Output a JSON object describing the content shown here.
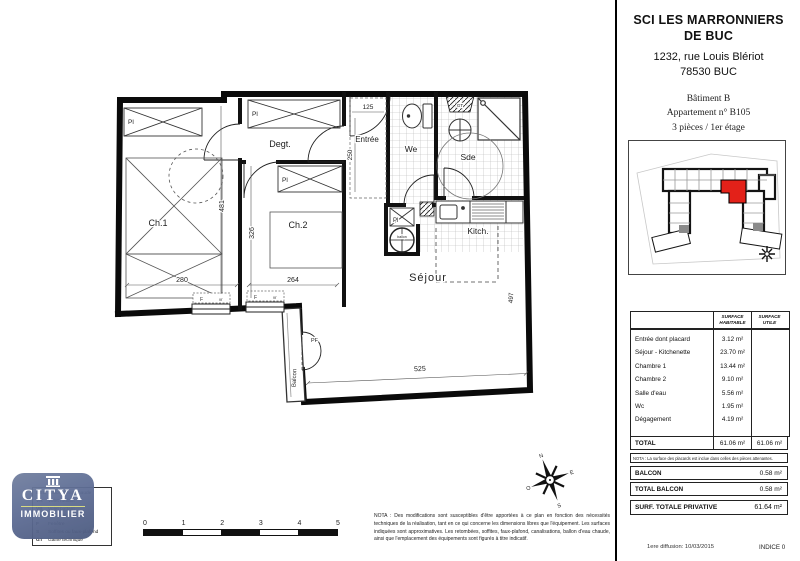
{
  "colors": {
    "unit_red": "#e32119",
    "logo_blue": "#5e6d95"
  },
  "title_block": {
    "company_line1": "SCI LES MARRONNIERS",
    "company_line2": "DE BUC",
    "address_line1": "1232, rue Louis Blériot",
    "address_line2": "78530 BUC",
    "building": "Bâtiment B",
    "apartment": "Appartement n° B105",
    "type_floor": "3 pièces / 1er étage"
  },
  "surface_table": {
    "col_habitable": "SURFACE HABITABLE",
    "col_utile": "SURFACE UTILE",
    "rows": [
      {
        "label": "Entrée dont placard",
        "hab": "3.12 m²",
        "utile": ""
      },
      {
        "label": "Séjour - Kitchenette",
        "hab": "23.70 m²",
        "utile": ""
      },
      {
        "label": "Chambre 1",
        "hab": "13.44 m²",
        "utile": ""
      },
      {
        "label": "Chambre 2",
        "hab": "9.10 m²",
        "utile": ""
      },
      {
        "label": "Salle d'eau",
        "hab": "5.56 m²",
        "utile": ""
      },
      {
        "label": "Wc",
        "hab": "1.95 m²",
        "utile": ""
      },
      {
        "label": "Dégagement",
        "hab": "4.19 m²",
        "utile": ""
      }
    ],
    "total_label": "TOTAL",
    "total_hab": "61.06 m²",
    "total_utile": "61.06 m²",
    "nota": "NOTA : La surface des placards est inclue dans celles des pièces attenantes.",
    "balcon_label": "BALCON",
    "balcon_value": "0.58 m²",
    "total_balcon_label": "TOTAL BALCON",
    "total_balcon_value": "0.58 m²",
    "privative_label": "SURF. TOTALE PRIVATIVE",
    "privative_value": "61.64 m²"
  },
  "footer": {
    "diffusion": "1ere diffusion: 10/03/2015",
    "indice": "INDICE 0"
  },
  "plan": {
    "rooms": {
      "ch1": "Ch.1",
      "ch2": "Ch.2",
      "degt": "Degt.",
      "entree": "Entrée",
      "wc": "We",
      "sde": "Sde",
      "kitch": "Kitch.",
      "sejour": "Séjour",
      "balcon": "Balcon"
    },
    "dims": {
      "ch1_w": "280",
      "ch1_h": "481",
      "ch2_w": "264",
      "ch2_h": "326",
      "entree_w": "125",
      "entree_h": "250",
      "sejour_w": "525",
      "sejour_h": "497"
    },
    "tags": {
      "pl": "Pl",
      "pf": "PF",
      "f": "F",
      "vr": "vr",
      "ballon": "ballon",
      "gt": "GT"
    }
  },
  "scale_bar": {
    "ticks": [
      "0",
      "1",
      "2",
      "3",
      "4",
      "5"
    ]
  },
  "plan_nota": "NOTA : Des modifications sont susceptibles d'être apportées à ce plan en fonction des nécessités techniques de la réalisation, tant en ce qui concerne les dimensions libres que l'équipement. Les surfaces indiquées sont approximatives. Les retombées, soffites, faux-plafond, canalisations, ballon d'eau chaude, ainsi que l'emplacement des équipements sont figurés à titre indicatif.",
  "legend": {
    "rows": [
      {
        "key": "BEC",
        "label": "Ballon d'eau chaude"
      },
      {
        "key": "VR",
        "label": "Volet roulant"
      },
      {
        "key": "VB",
        "label": "Volet battant"
      },
      {
        "key": "PF",
        "label": "Porte-fenêtre"
      },
      {
        "key": "F",
        "label": "Fenêtre"
      },
      {
        "key": "S",
        "label": "Soffites ou faux-plafond"
      },
      {
        "key": "GT",
        "label": "Gaine technique"
      }
    ]
  },
  "logo": {
    "name": "CITYA",
    "sub": "IMMOBILIER"
  },
  "compass": {
    "n": "N",
    "s": "S",
    "e": "E",
    "o": "O"
  }
}
